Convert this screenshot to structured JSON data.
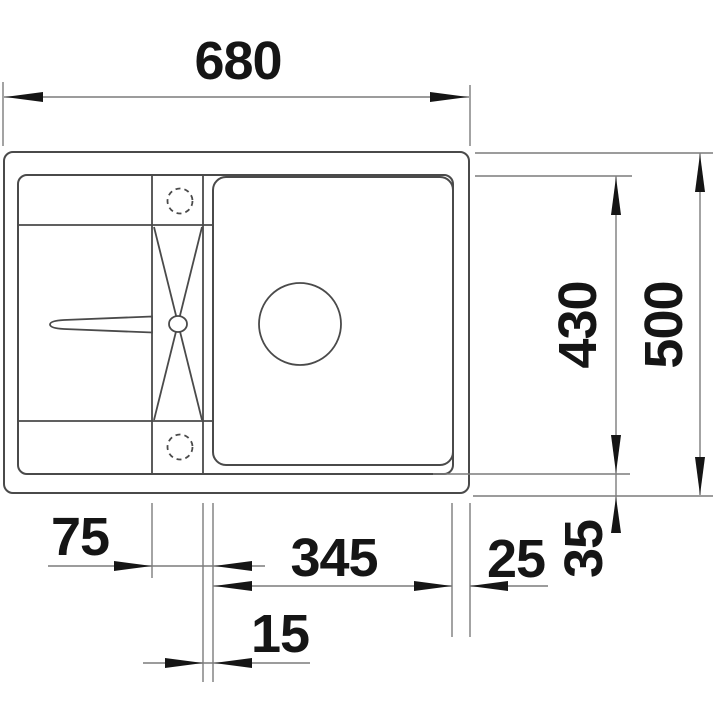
{
  "diagram": {
    "dimensions": {
      "overall_width": "680",
      "overall_depth": "500",
      "bowl_depth": "430",
      "bowl_width": "345",
      "tap_ledge_width": "75",
      "bowl_right_offset": "25",
      "front_rim_depth": "35",
      "step_offset": "15"
    },
    "colors": {
      "background": "#ffffff",
      "outline": "#4a4a4a",
      "dimension_line": "#7c7c7c",
      "annotation": "#151515"
    }
  }
}
